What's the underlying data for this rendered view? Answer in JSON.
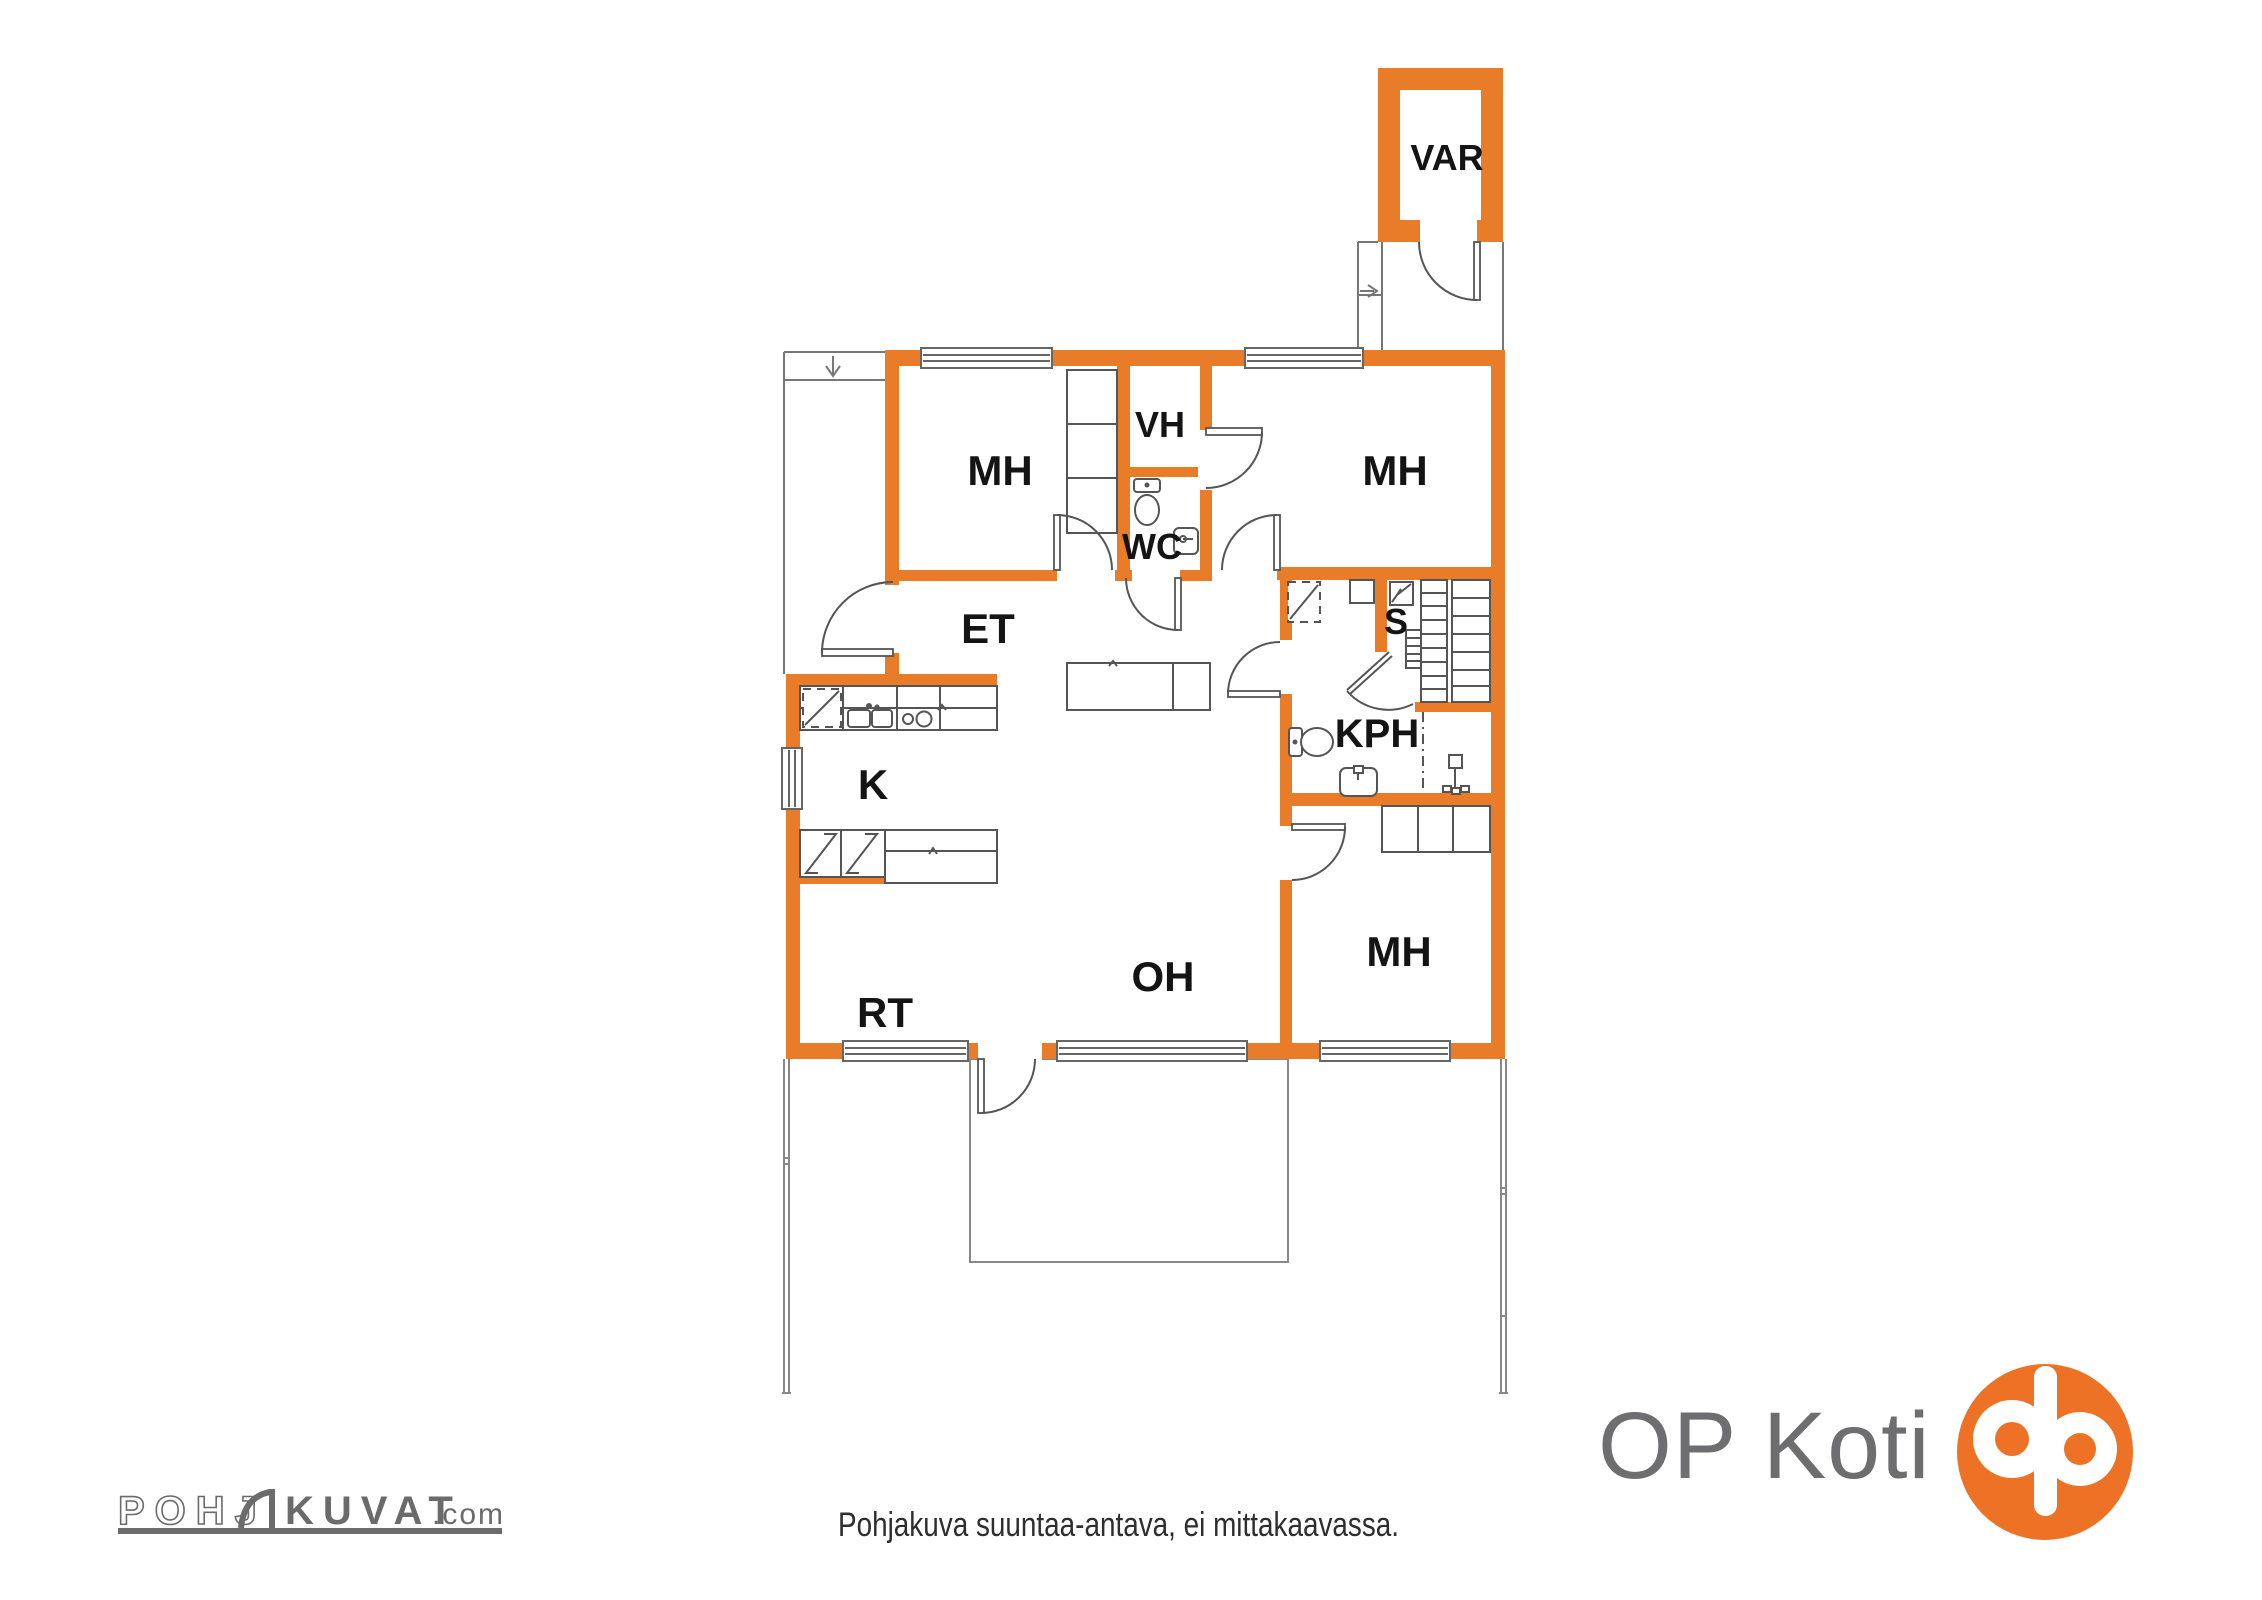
{
  "plan": {
    "rooms": [
      {
        "id": "var",
        "label": "VAR"
      },
      {
        "id": "mh-top-left",
        "label": "MH"
      },
      {
        "id": "vh",
        "label": "VH"
      },
      {
        "id": "mh-top-right",
        "label": "MH"
      },
      {
        "id": "wc",
        "label": "WC"
      },
      {
        "id": "et",
        "label": "ET"
      },
      {
        "id": "s",
        "label": "S"
      },
      {
        "id": "k",
        "label": "K"
      },
      {
        "id": "kph",
        "label": "KPH"
      },
      {
        "id": "rt",
        "label": "RT"
      },
      {
        "id": "oh",
        "label": "OH"
      },
      {
        "id": "mh-bottom",
        "label": "MH"
      }
    ]
  },
  "footer": {
    "disclaimer": "Pohjakuva suuntaa-antava, ei mittakaavassa.",
    "op_koti_label": "OP Koti",
    "pohjakuvat": {
      "part1": "POHJ",
      "part2": "KUVAT",
      "suffix": ".com"
    }
  },
  "colors": {
    "wall_orange": "#E87C29",
    "logo_orange": "#ED7226",
    "line_gray": "#5f5f5f",
    "brand_text_gray": "#6E6E71",
    "pohjakuvat_gray": "#6B6B6B",
    "label_black": "#141414",
    "disclaimer_gray": "#2E2E2E"
  }
}
